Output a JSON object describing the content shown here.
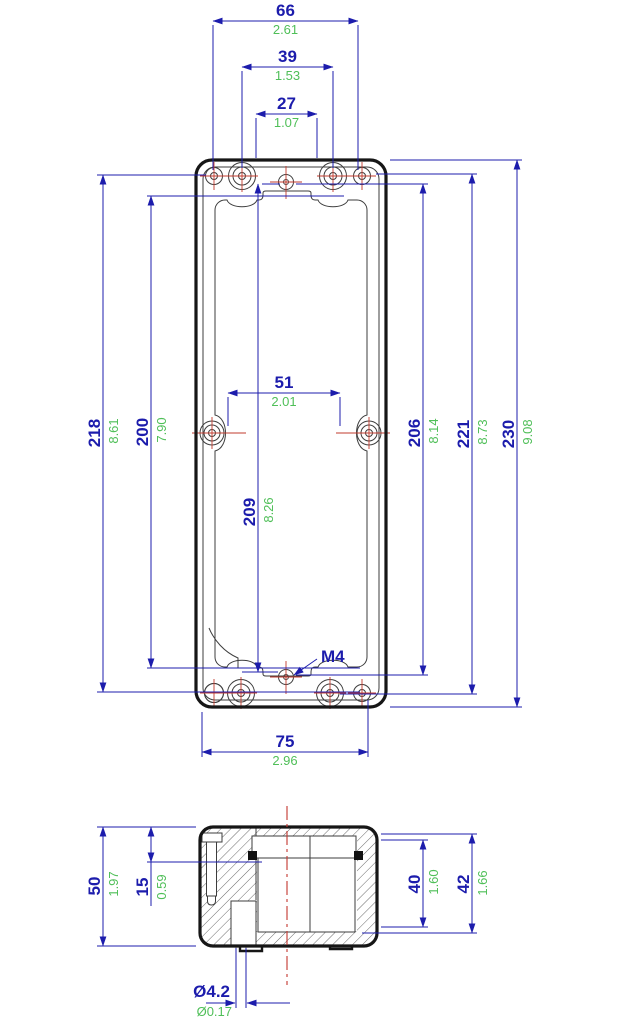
{
  "dims": {
    "d66": {
      "mm": "66",
      "in": "2.61"
    },
    "d39": {
      "mm": "39",
      "in": "1.53"
    },
    "d27": {
      "mm": "27",
      "in": "1.07"
    },
    "d51": {
      "mm": "51",
      "in": "2.01"
    },
    "d75": {
      "mm": "75",
      "in": "2.96"
    },
    "d218": {
      "mm": "218",
      "in": "8.61"
    },
    "d200": {
      "mm": "200",
      "in": "7.90"
    },
    "d209": {
      "mm": "209",
      "in": "8.26"
    },
    "d206": {
      "mm": "206",
      "in": "8.14"
    },
    "d221": {
      "mm": "221",
      "in": "8.73"
    },
    "d230": {
      "mm": "230",
      "in": "9.08"
    },
    "d50": {
      "mm": "50",
      "in": "1.97"
    },
    "d15": {
      "mm": "15",
      "in": "0.59"
    },
    "d40": {
      "mm": "40",
      "in": "1.60"
    },
    "d42": {
      "mm": "42",
      "in": "1.66"
    },
    "d4p2": {
      "mm": "Ø4.2",
      "in": "Ø0.17"
    }
  },
  "labels": {
    "thread": "M4"
  },
  "colors": {
    "dimension_blue": "#1c1cac",
    "inch_green": "#4fbf58",
    "outline_black": "#161616",
    "centerline_red": "#c23b2e"
  }
}
